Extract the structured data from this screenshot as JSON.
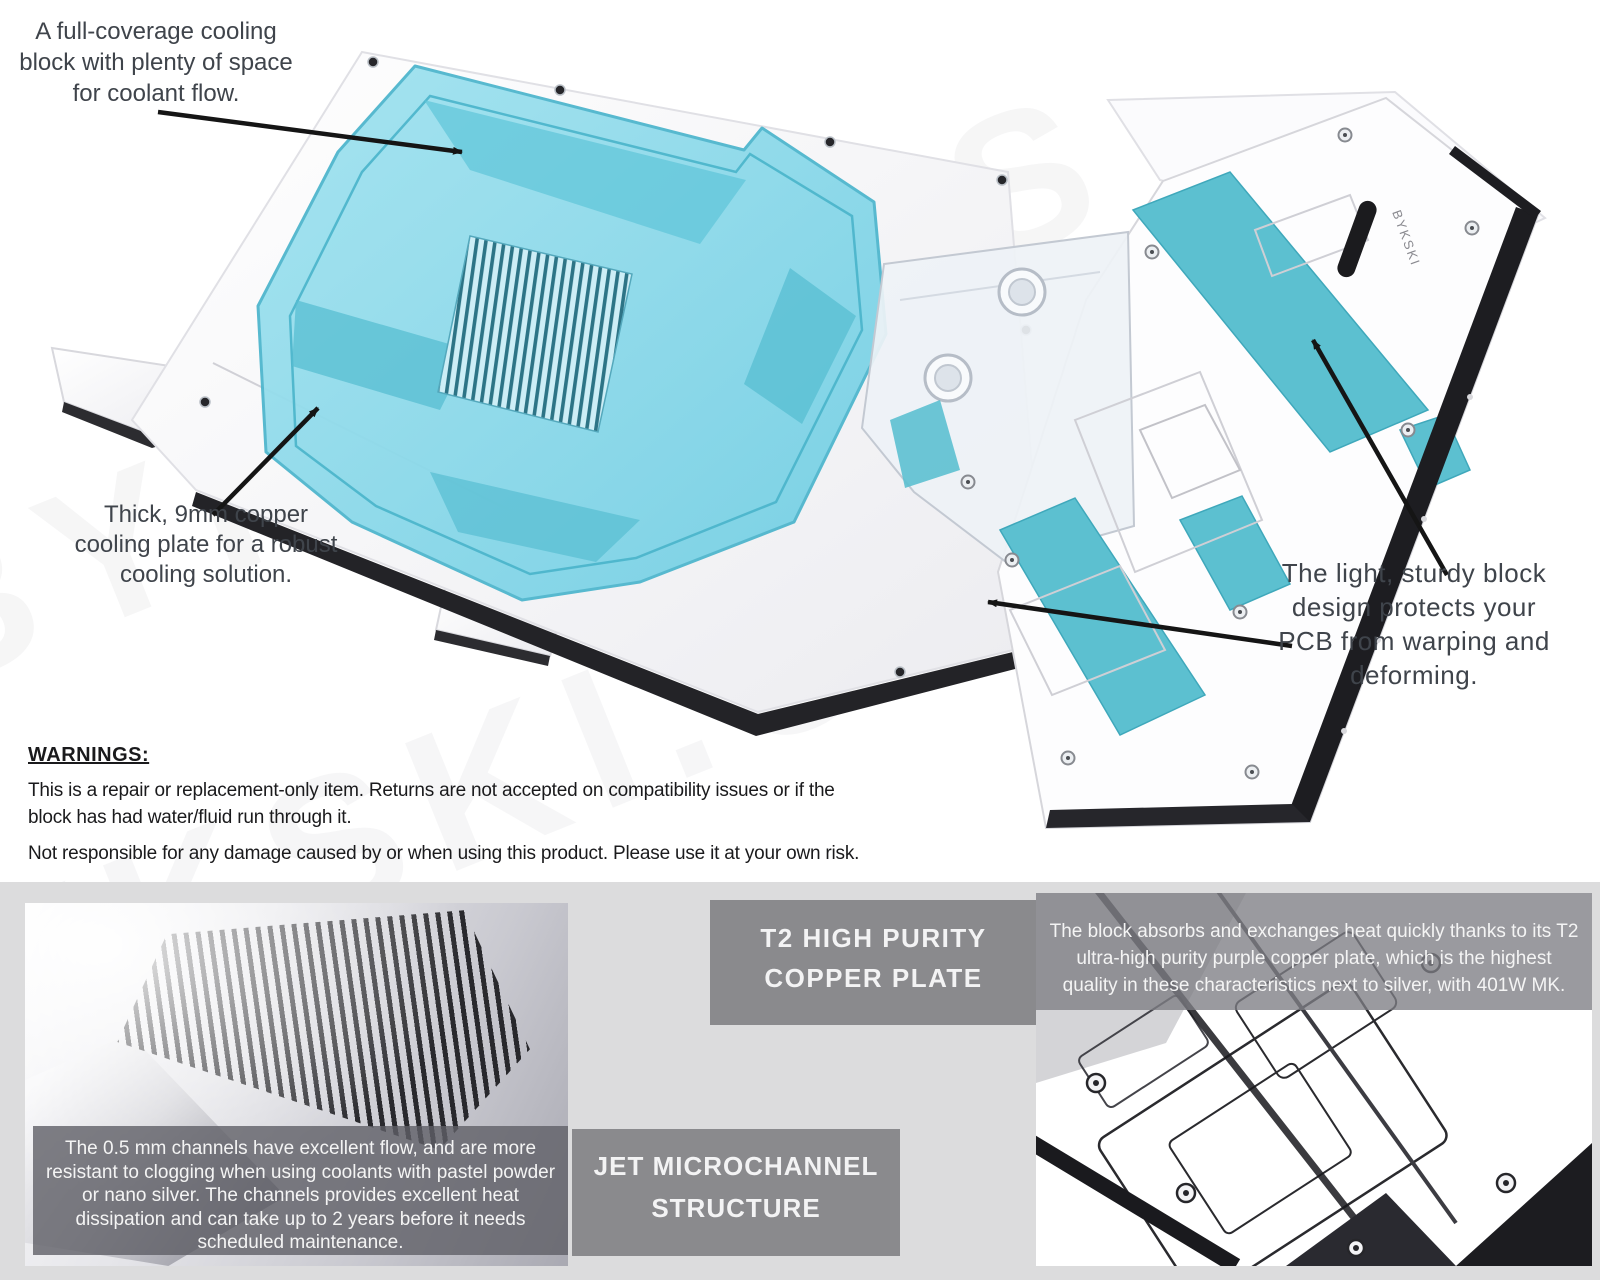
{
  "page": {
    "width": 1600,
    "height": 1280
  },
  "watermark": {
    "text": "BYKSKI.US"
  },
  "logo": {
    "text": "BYKSKI"
  },
  "callouts": [
    {
      "id": "coolant-flow",
      "lines": [
        "A full-coverage cooling",
        "block with plenty of space",
        "for coolant flow."
      ]
    },
    {
      "id": "copper-plate",
      "lines": [
        "Thick, 9mm copper",
        "cooling plate for a robust",
        "cooling solution."
      ]
    },
    {
      "id": "block-design",
      "lines": [
        "The light, sturdy block",
        "design protects your",
        "PCB from warping and",
        "deforming."
      ]
    }
  ],
  "warnings": {
    "heading": "WARNINGS:",
    "lines": [
      "This is a repair or replacement-only item. Returns are not accepted on compatibility issues or if the",
      "block has had water/fluid run through it.",
      "Not responsible for any damage caused by or when using this product. Please use it at your own risk."
    ]
  },
  "features": [
    {
      "title_lines": [
        "T2 HIGH PURITY",
        "COPPER PLATE"
      ],
      "desc_lines": [
        "The block absorbs and exchanges heat quickly thanks to its T2",
        "ultra-high purity purple copper plate, which is the highest",
        "quality in these characteristics next to silver, with 401W MK."
      ]
    },
    {
      "title_lines": [
        "JET MICROCHANNEL",
        "STRUCTURE"
      ],
      "desc_lines": [
        "The 0.5 mm channels have excellent flow, and are more",
        "resistant to clogging when using coolants with pastel powder",
        "or nano silver. The channels provides excellent heat",
        "dissipation and can take up to 2 years before it needs",
        "scheduled maintenance."
      ]
    }
  ],
  "colors": {
    "acrylic_cyan": "#8edae9",
    "acrylic_edge": "#49b4ca",
    "teal_patch": "#5cc0d0",
    "feature_box_gray": "#8a8a8d",
    "band_gray": "#dcdcdd",
    "callout_text": "#3f444b",
    "warning_text": "#1a1a1c",
    "caption_text": "#f4f4f4",
    "arrow_black": "#151515"
  }
}
